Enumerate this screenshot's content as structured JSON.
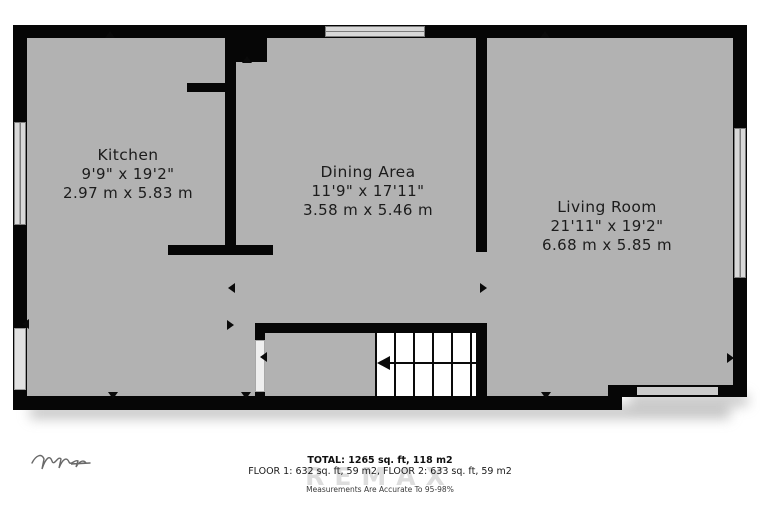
{
  "rooms": [
    {
      "name": "Kitchen",
      "imperial": "9'9\" x 19'2\"",
      "metric": "2.97 m x 5.83 m"
    },
    {
      "name": "Dining Area",
      "imperial": "11'9\" x 17'11\"",
      "metric": "3.58 m x 5.46 m"
    },
    {
      "name": "Living Room",
      "imperial": "21'11\" x 19'2\"",
      "metric": "6.68 m x 5.85 m"
    }
  ],
  "footer": {
    "total": "TOTAL: 1265 sq. ft, 118 m2",
    "floors": "FLOOR 1: 632 sq. ft, 59 m2, FLOOR 2: 633 sq. ft, 59 m2",
    "accuracy": "Measurements Are Accurate To 95-98%",
    "watermark": "REMAX"
  },
  "colors": {
    "floor": "#b2b2b2",
    "wall": "#060606",
    "window_fill": "#d8d8d8",
    "label_text": "#1c1c1c"
  }
}
